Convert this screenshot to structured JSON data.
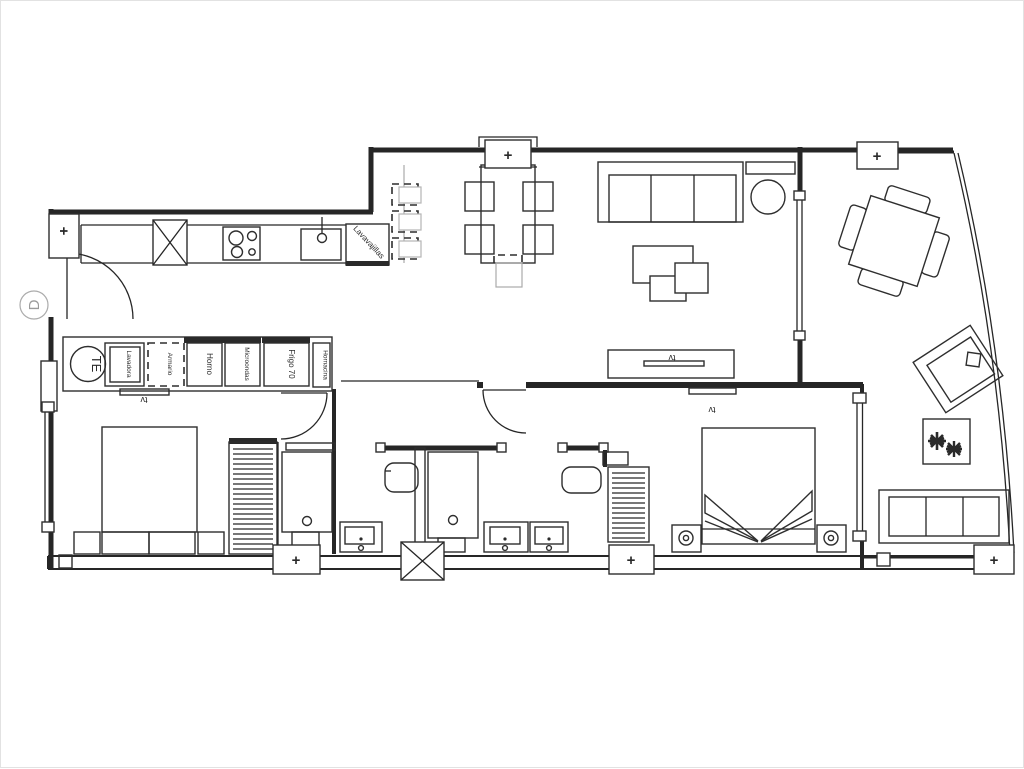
{
  "plan": {
    "kind": "apartment-floor-plan",
    "ink_color": "#262626",
    "muted_color": "#ababab"
  },
  "labels": {
    "door_marker": "D",
    "water_heater": "TE",
    "dishwasher": "Lavavajillas",
    "tv": "tv",
    "window_mark": "+"
  },
  "appliances": {
    "items": [
      {
        "label": "Lavadora"
      },
      {
        "label": "Armario"
      },
      {
        "label": "Horno"
      },
      {
        "label": "Microondas"
      },
      {
        "label": "Frigo 70"
      },
      {
        "label": "Hornacina"
      }
    ]
  }
}
